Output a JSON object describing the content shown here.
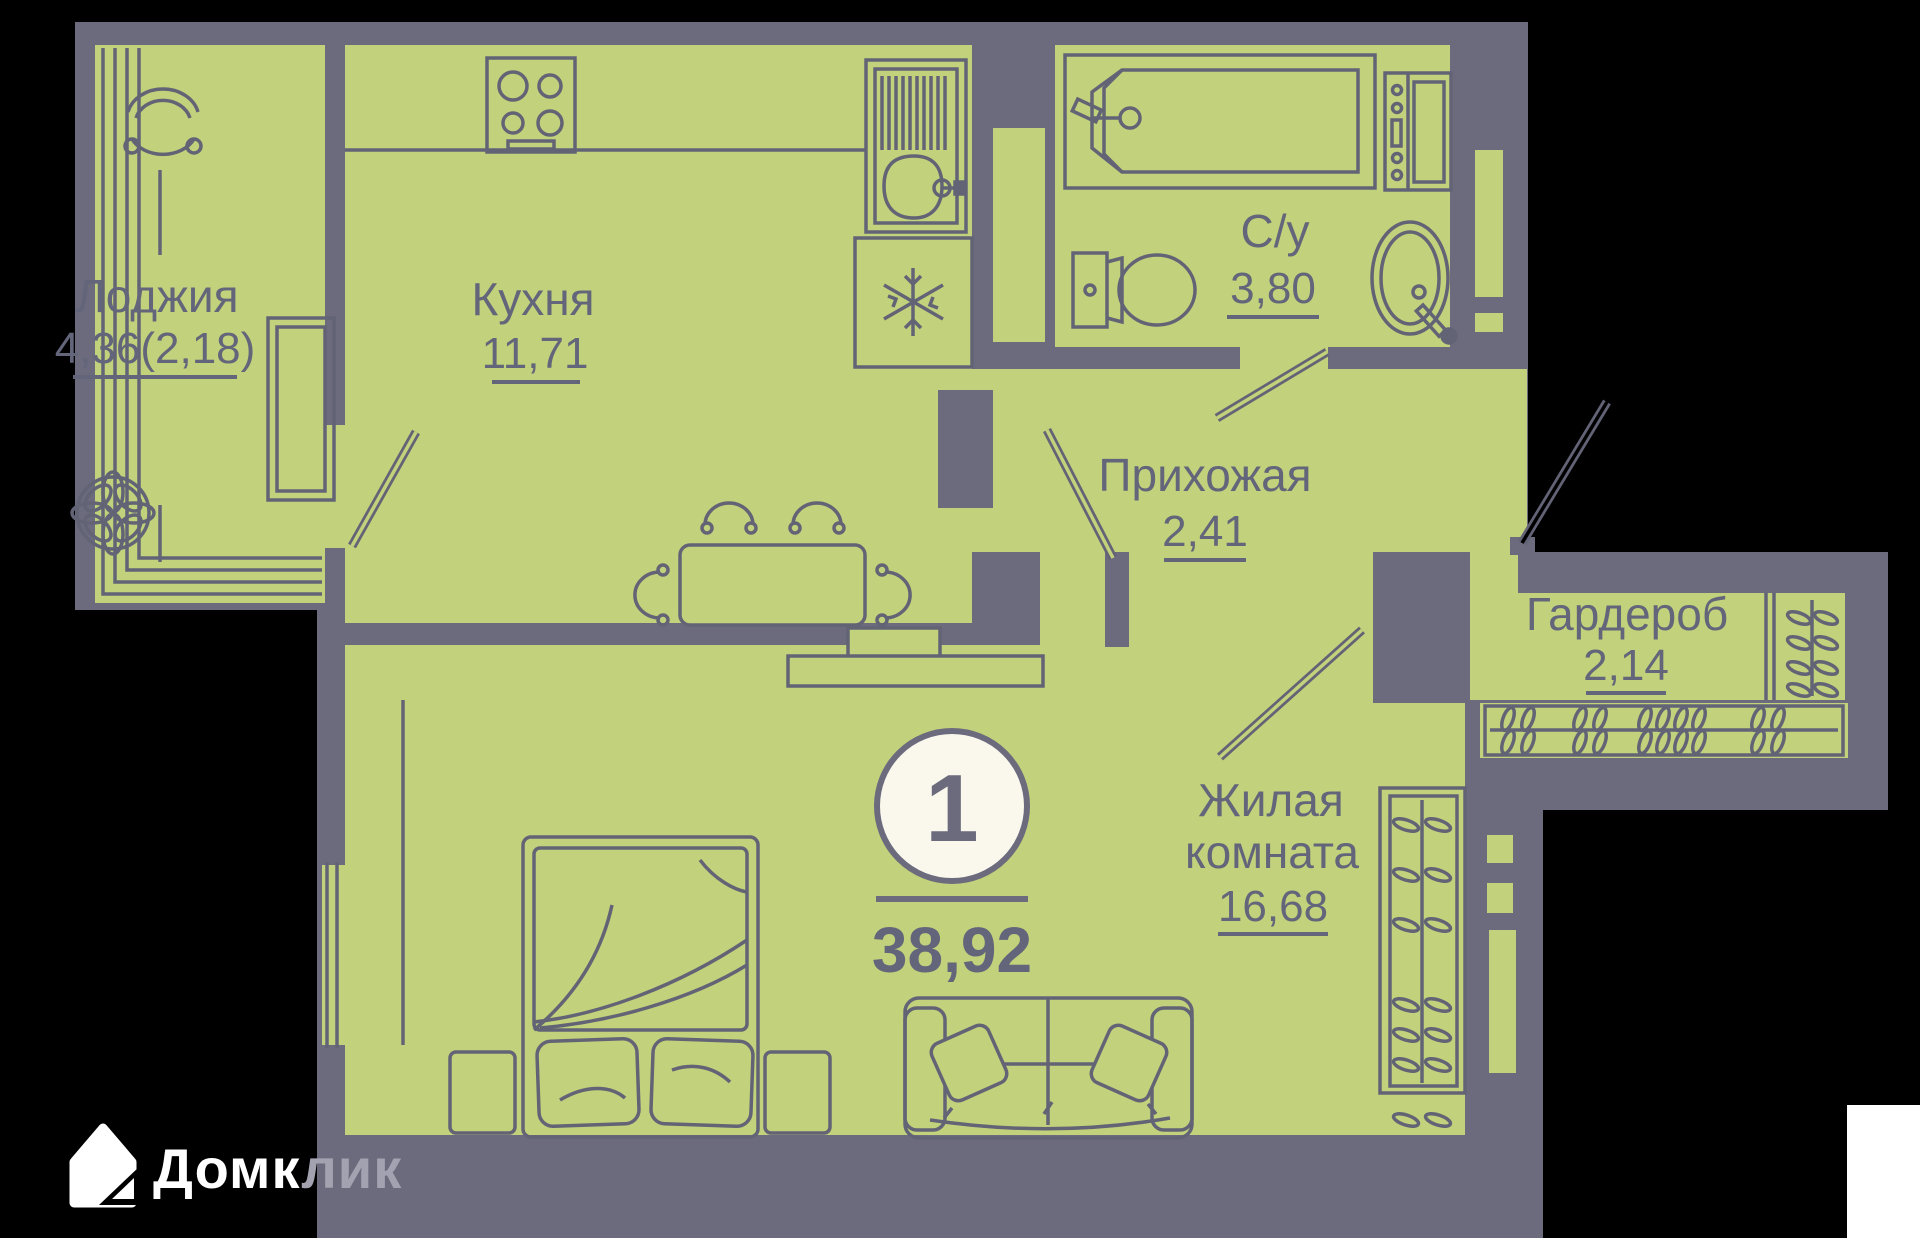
{
  "title": "Floor plan of 1-room apartment",
  "rooms": [
    {
      "id": "loggia",
      "name": "Лоджия",
      "area": "4,36(2,18)"
    },
    {
      "id": "kitchen",
      "name": "Кухня",
      "area": "11,71"
    },
    {
      "id": "bathroom",
      "name": "С/у",
      "area": "3,80"
    },
    {
      "id": "hallway",
      "name": "Прихожая",
      "area": "2,41"
    },
    {
      "id": "wardrobe",
      "name": "Гардероб",
      "area": "2,14"
    },
    {
      "id": "living-room",
      "name": "Жилая комната",
      "name_line1": "Жилая",
      "name_line2": "комната",
      "area": "16,68"
    }
  ],
  "summary": {
    "rooms_count": "1",
    "total_area": "38,92"
  },
  "logo": {
    "text": "Домклик",
    "text_primary": "Домк",
    "text_overlap": "лик"
  },
  "colors": {
    "background": "#000000",
    "page": "#ffffff",
    "walls": "#6b6b7d",
    "floor": "#c2d17b",
    "outline": "#626476",
    "label_text": "#63657a",
    "badge_fill": "#faf7ec",
    "logo_white": "#ffffff",
    "logo_faded": "#a3a2b1"
  }
}
